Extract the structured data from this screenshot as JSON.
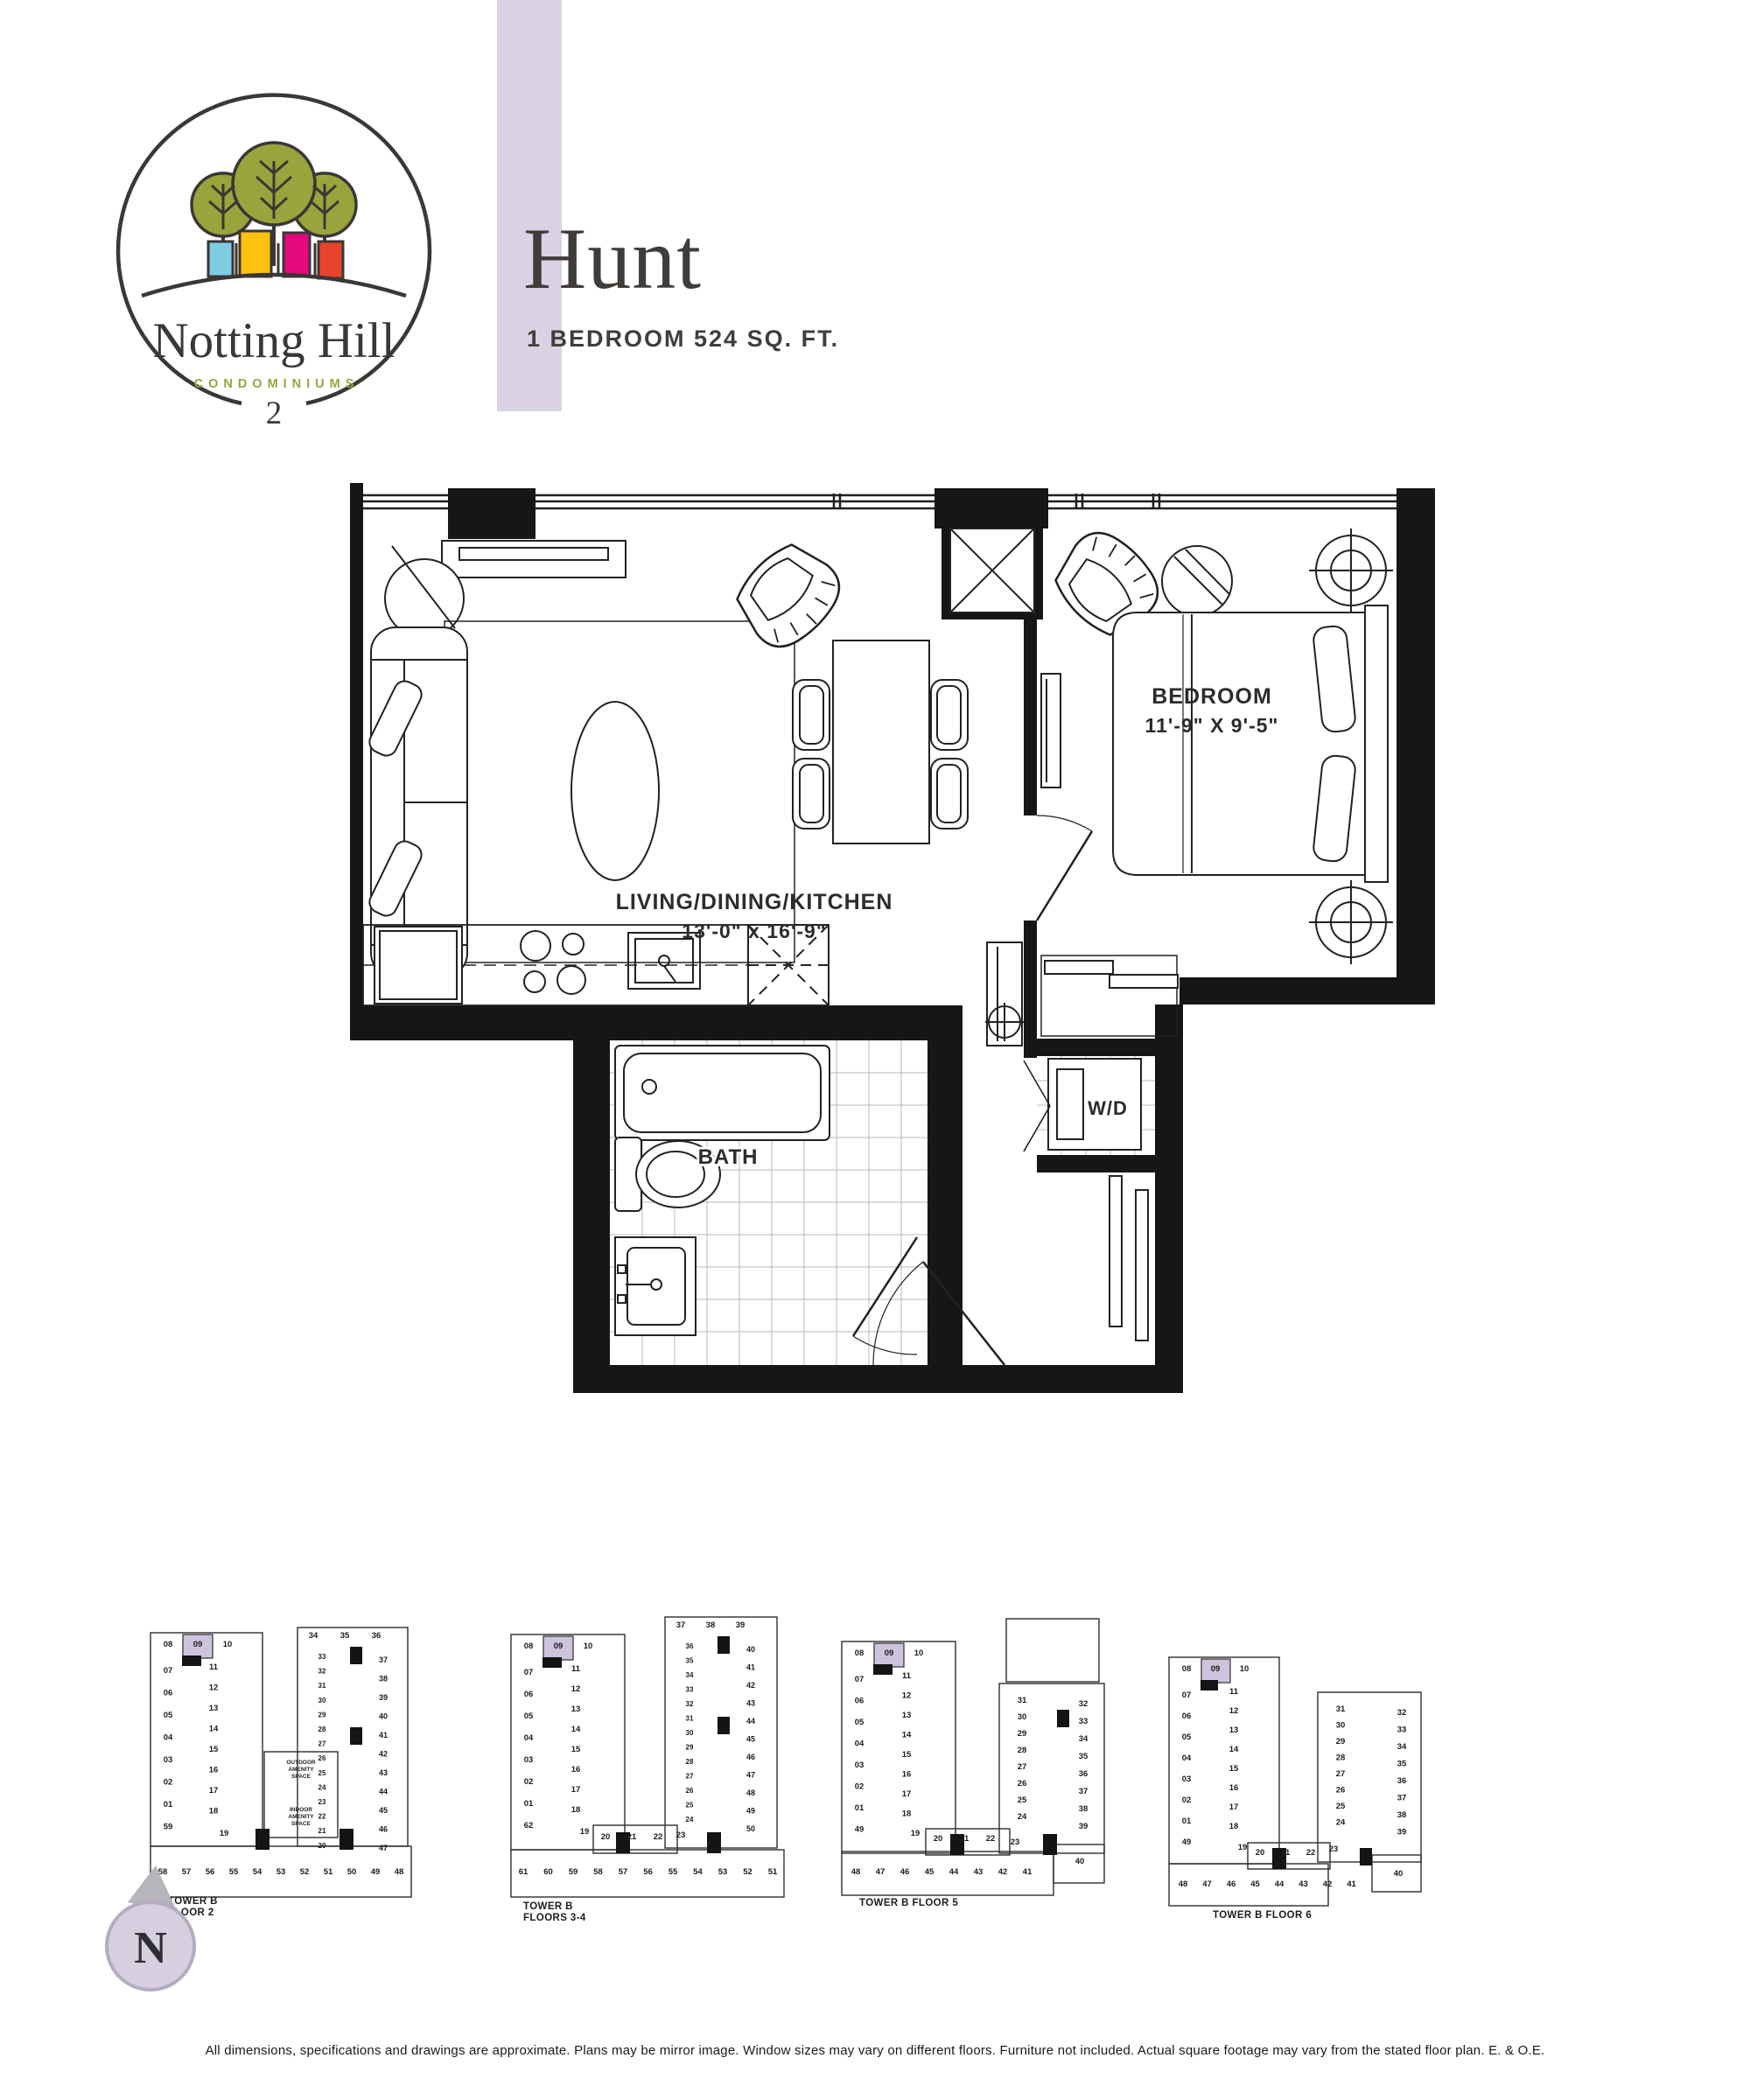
{
  "colors": {
    "accent_lavender": "#D9D1E4",
    "highlight_unit": "#CDC3DC",
    "logo_olive": "#9AA43C",
    "logo_dark": "#3B3735",
    "logo_blue": "#7FCBE2",
    "logo_yellow": "#FFC20E",
    "logo_magenta": "#E5087E",
    "logo_orange": "#E8432D",
    "wall_black": "#161616"
  },
  "logo": {
    "name": "Notting Hill",
    "sub": "CONDOMINIUMS",
    "tower_number": "2"
  },
  "header": {
    "title": "Hunt",
    "subtitle": "1 BEDROOM 524 SQ. FT."
  },
  "plan": {
    "rooms": [
      {
        "name": "LIVING/DINING/KITCHEN",
        "dims": "13'-0\" x 16'-9\""
      },
      {
        "name": "BEDROOM",
        "dims": "11'-9\" X 9'-5\""
      },
      {
        "name": "BATH",
        "dims": ""
      },
      {
        "name": "W/D",
        "dims": ""
      }
    ]
  },
  "north": {
    "label": "N"
  },
  "keyplans": [
    {
      "caption": [
        "TOWER B",
        "FLOOR 2"
      ],
      "highlight_unit": "09",
      "units": {
        "top": [
          "08",
          "09",
          "10"
        ],
        "left": [
          "07",
          "06",
          "05",
          "04",
          "03",
          "02",
          "01",
          "59"
        ],
        "middle": [
          "11",
          "12",
          "13",
          "14",
          "15",
          "16",
          "17",
          "18"
        ],
        "middle_lower": [
          "19"
        ],
        "bottom": [
          "58",
          "57",
          "56",
          "55",
          "54",
          "53",
          "52",
          "51",
          "50",
          "49",
          "48"
        ],
        "wing_top": [
          "34",
          "35",
          "36"
        ],
        "wing_inner": [
          "33",
          "32",
          "31",
          "30",
          "29",
          "28",
          "27",
          "26",
          "25",
          "24",
          "23",
          "22",
          "21",
          "20"
        ],
        "wing_outer": [
          "37",
          "38",
          "39",
          "40",
          "41",
          "42",
          "43",
          "44",
          "45",
          "46",
          "47"
        ]
      },
      "amenity": [
        [
          "OUTDOOR",
          "AMENITY",
          "SPACE"
        ],
        [
          "INDOOR",
          "AMENITY",
          "SPACE"
        ]
      ]
    },
    {
      "caption": [
        "TOWER B",
        "FLOORS 3-4"
      ],
      "highlight_unit": "09",
      "units": {
        "top": [
          "08",
          "09",
          "10"
        ],
        "left": [
          "07",
          "06",
          "05",
          "04",
          "03",
          "02",
          "01",
          "62"
        ],
        "middle": [
          "11",
          "12",
          "13",
          "14",
          "15",
          "16",
          "17",
          "18"
        ],
        "middle_lower": [
          "19"
        ],
        "center": [
          "20",
          "21",
          "22"
        ],
        "bottom": [
          "61",
          "60",
          "59",
          "58",
          "57",
          "56",
          "55",
          "54",
          "53",
          "52",
          "51"
        ],
        "wing_top": [
          "37",
          "38",
          "39"
        ],
        "wing_inner": [
          "36",
          "35",
          "34",
          "33",
          "32",
          "31",
          "30",
          "29",
          "28",
          "27",
          "26",
          "25",
          "24"
        ],
        "wing_23": [
          "23"
        ],
        "wing_outer": [
          "40",
          "41",
          "42",
          "43",
          "44",
          "45",
          "46",
          "47",
          "48",
          "49",
          "50"
        ]
      },
      "amenity": []
    },
    {
      "caption": [
        "TOWER B  FLOOR 5"
      ],
      "highlight_unit": "09",
      "units": {
        "top": [
          "08",
          "09",
          "10"
        ],
        "left": [
          "07",
          "06",
          "05",
          "04",
          "03",
          "02",
          "01",
          "49"
        ],
        "middle": [
          "11",
          "12",
          "13",
          "14",
          "15",
          "16",
          "17",
          "18"
        ],
        "middle_lower": [
          "19"
        ],
        "center": [
          "20",
          "21",
          "22"
        ],
        "bottom": [
          "48",
          "47",
          "46",
          "45",
          "44",
          "43",
          "42",
          "41"
        ],
        "wing_40": [
          "40"
        ],
        "wing_inner": [
          "31",
          "30",
          "29",
          "28",
          "27",
          "26",
          "25",
          "24"
        ],
        "wing_23": [
          "23"
        ],
        "wing_outer": [
          "32",
          "33",
          "34",
          "35",
          "36",
          "37",
          "38",
          "39"
        ]
      },
      "amenity": []
    },
    {
      "caption": [
        "TOWER B  FLOOR 6"
      ],
      "highlight_unit": "09",
      "units": {
        "top": [
          "08",
          "09",
          "10"
        ],
        "left": [
          "07",
          "06",
          "05",
          "04",
          "03",
          "02",
          "01",
          "49"
        ],
        "middle": [
          "11",
          "12",
          "13",
          "14",
          "15",
          "16",
          "17",
          "18"
        ],
        "middle_lower": [
          "19"
        ],
        "center": [
          "20",
          "21",
          "22"
        ],
        "bottom": [
          "48",
          "47",
          "46",
          "45",
          "44",
          "43",
          "42",
          "41"
        ],
        "wing_40": [
          "40"
        ],
        "wing_inner": [
          "31",
          "30",
          "29",
          "28",
          "27",
          "26",
          "25",
          "24"
        ],
        "wing_23": [
          "23"
        ],
        "wing_outer": [
          "32",
          "33",
          "34",
          "35",
          "36",
          "37",
          "38",
          "39"
        ]
      },
      "amenity": []
    }
  ],
  "footer": "All dimensions, specifications and drawings are approximate. Plans may be mirror image. Window sizes may vary on different floors. Furniture not included. Actual square footage may vary from the stated floor plan. E. & O.E."
}
